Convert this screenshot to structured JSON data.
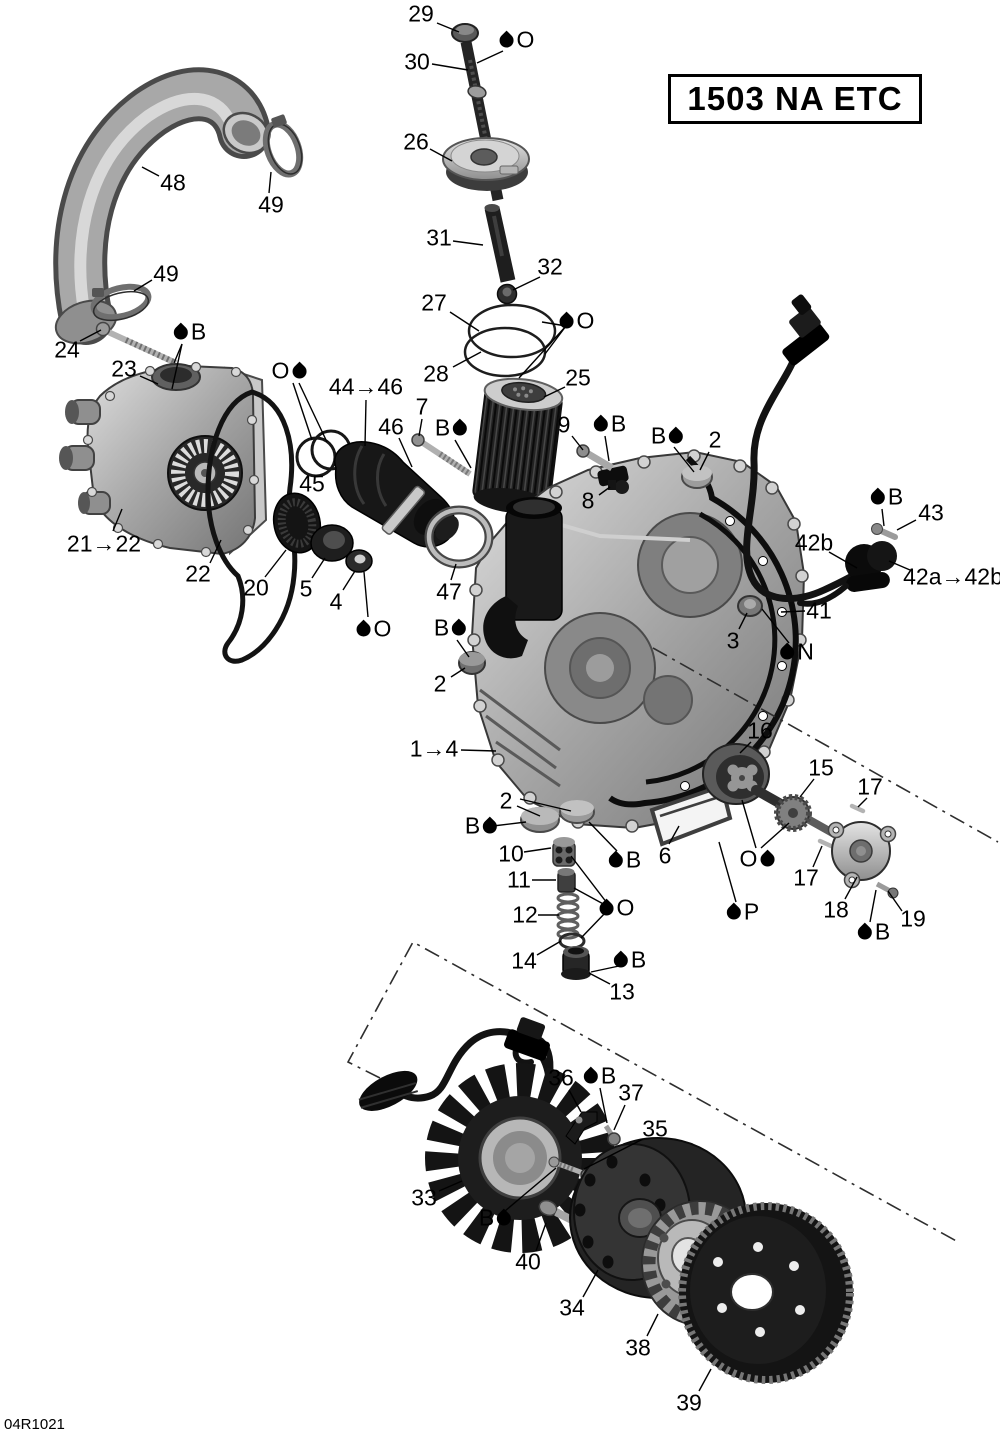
{
  "title_box": {
    "text": "1503 NA ETC"
  },
  "doc_code": "04R1021",
  "callouts": [
    {
      "text": "29",
      "x": 421,
      "y": 14,
      "leaders": [
        [
          437,
          23,
          459,
          32
        ]
      ]
    },
    {
      "text": "30",
      "x": 417,
      "y": 62,
      "leaders": [
        [
          432,
          64,
          468,
          70
        ]
      ]
    },
    {
      "text": "26",
      "x": 416,
      "y": 142,
      "leaders": [
        [
          430,
          149,
          452,
          161
        ]
      ]
    },
    {
      "text": "31",
      "x": 439,
      "y": 238,
      "leaders": [
        [
          453,
          241,
          483,
          245
        ]
      ]
    },
    {
      "text": "32",
      "x": 550,
      "y": 267,
      "leaders": [
        [
          540,
          277,
          513,
          290
        ]
      ]
    },
    {
      "text": "27",
      "x": 434,
      "y": 303,
      "leaders": [
        [
          450,
          312,
          479,
          331
        ]
      ]
    },
    {
      "text": "28",
      "x": 436,
      "y": 374,
      "leaders": [
        [
          453,
          367,
          481,
          352
        ]
      ]
    },
    {
      "text": "25",
      "x": 578,
      "y": 378,
      "leaders": [
        [
          565,
          387,
          544,
          397
        ]
      ]
    },
    {
      "text": "48",
      "x": 173,
      "y": 183,
      "leaders": [
        [
          159,
          176,
          142,
          167
        ]
      ]
    },
    {
      "text": "49",
      "x": 271,
      "y": 205,
      "leaders": [
        [
          269,
          193,
          271,
          172
        ]
      ]
    },
    {
      "text": "49",
      "x": 166,
      "y": 274,
      "leaders": [
        [
          152,
          280,
          134,
          291
        ]
      ]
    },
    {
      "text": "24",
      "x": 67,
      "y": 350,
      "leaders": [
        [
          80,
          341,
          101,
          330
        ]
      ]
    },
    {
      "text": "23",
      "x": 124,
      "y": 369,
      "leaders": [
        [
          140,
          376,
          158,
          384
        ]
      ]
    },
    {
      "text": "21→22",
      "x": 104,
      "y": 544,
      "leaders": [
        [
          113,
          531,
          122,
          509
        ]
      ]
    },
    {
      "text": "22",
      "x": 198,
      "y": 574,
      "leaders": [
        [
          210,
          563,
          221,
          540
        ]
      ]
    },
    {
      "text": "20",
      "x": 256,
      "y": 588,
      "leaders": [
        [
          265,
          577,
          286,
          550
        ]
      ]
    },
    {
      "text": "5",
      "x": 306,
      "y": 589,
      "leaders": [
        [
          312,
          578,
          325,
          558
        ]
      ]
    },
    {
      "text": "4",
      "x": 336,
      "y": 602,
      "leaders": [
        [
          343,
          590,
          355,
          571
        ]
      ]
    },
    {
      "text": "45",
      "x": 312,
      "y": 484,
      "leaders": []
    },
    {
      "text": "44→46",
      "x": 366,
      "y": 387,
      "leaders": [
        [
          366,
          400,
          365,
          446
        ]
      ]
    },
    {
      "text": "46",
      "x": 391,
      "y": 427,
      "leaders": [
        [
          399,
          438,
          412,
          467
        ]
      ]
    },
    {
      "text": "7",
      "x": 422,
      "y": 407,
      "leaders": [
        [
          422,
          419,
          419,
          436
        ]
      ]
    },
    {
      "text": "9",
      "x": 564,
      "y": 425,
      "leaders": [
        [
          572,
          436,
          583,
          450
        ]
      ]
    },
    {
      "text": "2",
      "x": 715,
      "y": 440,
      "leaders": [
        [
          709,
          452,
          700,
          470
        ]
      ]
    },
    {
      "text": "8",
      "x": 588,
      "y": 501,
      "leaders": [
        [
          599,
          495,
          610,
          487
        ]
      ]
    },
    {
      "text": "43",
      "x": 931,
      "y": 513,
      "leaders": [
        [
          916,
          520,
          897,
          530
        ]
      ]
    },
    {
      "text": "42b",
      "x": 814,
      "y": 543,
      "leaders": [
        [
          829,
          552,
          857,
          568
        ]
      ]
    },
    {
      "text": "42a→42b",
      "x": 953,
      "y": 577,
      "leaders": [
        [
          910,
          570,
          889,
          561
        ]
      ]
    },
    {
      "text": "41",
      "x": 819,
      "y": 611,
      "leaders": [
        [
          805,
          611,
          781,
          612
        ]
      ]
    },
    {
      "text": "3",
      "x": 733,
      "y": 641,
      "leaders": [
        [
          739,
          629,
          747,
          613
        ]
      ]
    },
    {
      "text": "47",
      "x": 449,
      "y": 592,
      "leaders": [
        [
          451,
          580,
          456,
          564
        ]
      ]
    },
    {
      "text": "2",
      "x": 440,
      "y": 684,
      "leaders": [
        [
          451,
          677,
          465,
          668
        ]
      ]
    },
    {
      "text": "1→4",
      "x": 434,
      "y": 749,
      "leaders": [
        [
          461,
          750,
          496,
          751
        ]
      ]
    },
    {
      "text": "2",
      "x": 506,
      "y": 801,
      "leaders": [
        [
          517,
          806,
          540,
          816
        ],
        [
          520,
          799,
          571,
          811
        ]
      ]
    },
    {
      "text": "10",
      "x": 511,
      "y": 854,
      "leaders": [
        [
          524,
          852,
          551,
          848
        ]
      ]
    },
    {
      "text": "11",
      "x": 519,
      "y": 880,
      "leaders": [
        [
          532,
          880,
          556,
          880
        ]
      ]
    },
    {
      "text": "12",
      "x": 525,
      "y": 915,
      "leaders": [
        [
          538,
          915,
          559,
          915
        ]
      ]
    },
    {
      "text": "14",
      "x": 524,
      "y": 961,
      "leaders": [
        [
          537,
          955,
          561,
          941
        ]
      ]
    },
    {
      "text": "13",
      "x": 622,
      "y": 992,
      "leaders": [
        [
          610,
          984,
          589,
          973
        ]
      ]
    },
    {
      "text": "6",
      "x": 665,
      "y": 856,
      "leaders": [
        [
          669,
          844,
          679,
          826
        ]
      ]
    },
    {
      "text": "16",
      "x": 760,
      "y": 731,
      "leaders": [
        [
          751,
          742,
          740,
          753
        ]
      ]
    },
    {
      "text": "15",
      "x": 821,
      "y": 768,
      "leaders": [
        [
          814,
          779,
          800,
          797
        ]
      ]
    },
    {
      "text": "17",
      "x": 870,
      "y": 787,
      "leaders": [
        [
          867,
          798,
          858,
          807
        ]
      ]
    },
    {
      "text": "17",
      "x": 806,
      "y": 878,
      "leaders": [
        [
          813,
          867,
          822,
          846
        ]
      ]
    },
    {
      "text": "18",
      "x": 836,
      "y": 910,
      "leaders": [
        [
          845,
          899,
          857,
          877
        ]
      ]
    },
    {
      "text": "19",
      "x": 913,
      "y": 919,
      "leaders": [
        [
          902,
          911,
          888,
          891
        ]
      ]
    },
    {
      "text": "33",
      "x": 424,
      "y": 1198,
      "leaders": [
        [
          439,
          1191,
          462,
          1181
        ]
      ]
    },
    {
      "text": "36",
      "x": 561,
      "y": 1078,
      "leaders": [
        [
          569,
          1090,
          581,
          1112
        ]
      ]
    },
    {
      "text": "37",
      "x": 631,
      "y": 1093,
      "leaders": [
        [
          625,
          1105,
          614,
          1130
        ]
      ]
    },
    {
      "text": "35",
      "x": 655,
      "y": 1129,
      "leaders": [
        [
          643,
          1139,
          584,
          1169
        ]
      ]
    },
    {
      "text": "40",
      "x": 528,
      "y": 1262,
      "leaders": [
        [
          536,
          1251,
          546,
          1223
        ]
      ]
    },
    {
      "text": "34",
      "x": 572,
      "y": 1308,
      "leaders": [
        [
          583,
          1297,
          598,
          1270
        ]
      ]
    },
    {
      "text": "38",
      "x": 638,
      "y": 1348,
      "leaders": [
        [
          647,
          1336,
          658,
          1314
        ]
      ]
    },
    {
      "text": "39",
      "x": 689,
      "y": 1403,
      "leaders": [
        [
          699,
          1391,
          711,
          1369
        ]
      ]
    }
  ],
  "lube_marks": [
    {
      "letter": "O",
      "order": "drop-first",
      "x": 517,
      "y": 40,
      "leaders": [
        [
          503,
          51,
          477,
          63
        ]
      ]
    },
    {
      "letter": "O",
      "order": "drop-first",
      "x": 577,
      "y": 321,
      "leaders": [
        [
          566,
          326,
          542,
          322
        ],
        [
          566,
          326,
          545,
          354
        ],
        [
          566,
          326,
          519,
          378
        ]
      ]
    },
    {
      "letter": "B",
      "order": "drop-first",
      "x": 190,
      "y": 332,
      "leaders": [
        [
          182,
          344,
          174,
          363
        ],
        [
          182,
          344,
          172,
          389
        ]
      ]
    },
    {
      "letter": "O",
      "order": "letter-first",
      "x": 289,
      "y": 371,
      "leaders": [
        [
          293,
          383,
          312,
          440
        ],
        [
          299,
          383,
          327,
          442
        ]
      ]
    },
    {
      "letter": "B",
      "order": "letter-first",
      "x": 451,
      "y": 428,
      "leaders": [
        [
          455,
          440,
          471,
          468
        ]
      ]
    },
    {
      "letter": "B",
      "order": "drop-first",
      "x": 610,
      "y": 424,
      "leaders": [
        [
          605,
          436,
          609,
          461
        ]
      ]
    },
    {
      "letter": "B",
      "order": "letter-first",
      "x": 667,
      "y": 436,
      "leaders": [
        [
          674,
          447,
          694,
          472
        ]
      ]
    },
    {
      "letter": "B",
      "order": "drop-first",
      "x": 887,
      "y": 497,
      "leaders": [
        [
          882,
          509,
          884,
          526
        ]
      ]
    },
    {
      "letter": "N",
      "order": "drop-first",
      "x": 797,
      "y": 652,
      "leaders": [
        [
          789,
          643,
          762,
          609
        ]
      ]
    },
    {
      "letter": "O",
      "order": "drop-first",
      "x": 374,
      "y": 629,
      "leaders": [
        [
          368,
          617,
          364,
          572
        ]
      ]
    },
    {
      "letter": "B",
      "order": "letter-first",
      "x": 450,
      "y": 628,
      "leaders": [
        [
          457,
          640,
          469,
          657
        ]
      ]
    },
    {
      "letter": "B",
      "order": "letter-first",
      "x": 481,
      "y": 826,
      "leaders": [
        [
          493,
          826,
          526,
          822
        ]
      ]
    },
    {
      "letter": "B",
      "order": "drop-first",
      "x": 625,
      "y": 860,
      "leaders": [
        [
          617,
          851,
          589,
          822
        ]
      ]
    },
    {
      "letter": "O",
      "order": "drop-first",
      "x": 617,
      "y": 908,
      "leaders": [
        [
          607,
          903,
          571,
          856
        ],
        [
          607,
          906,
          574,
          888
        ],
        [
          607,
          911,
          581,
          938
        ]
      ]
    },
    {
      "letter": "B",
      "order": "drop-first",
      "x": 630,
      "y": 960,
      "leaders": [
        [
          619,
          966,
          591,
          972
        ]
      ]
    },
    {
      "letter": "O",
      "order": "letter-first",
      "x": 757,
      "y": 859,
      "leaders": [
        [
          756,
          848,
          742,
          800
        ],
        [
          761,
          848,
          789,
          823
        ]
      ]
    },
    {
      "letter": "P",
      "order": "drop-first",
      "x": 743,
      "y": 912,
      "leaders": [
        [
          736,
          902,
          719,
          842
        ]
      ]
    },
    {
      "letter": "B",
      "order": "drop-first",
      "x": 874,
      "y": 932,
      "leaders": [
        [
          870,
          922,
          876,
          890
        ]
      ]
    },
    {
      "letter": "B",
      "order": "drop-first",
      "x": 600,
      "y": 1076,
      "leaders": [
        [
          600,
          1088,
          607,
          1123
        ]
      ]
    },
    {
      "letter": "B",
      "order": "letter-first",
      "x": 495,
      "y": 1218,
      "leaders": [
        [
          505,
          1211,
          556,
          1168
        ]
      ]
    }
  ]
}
